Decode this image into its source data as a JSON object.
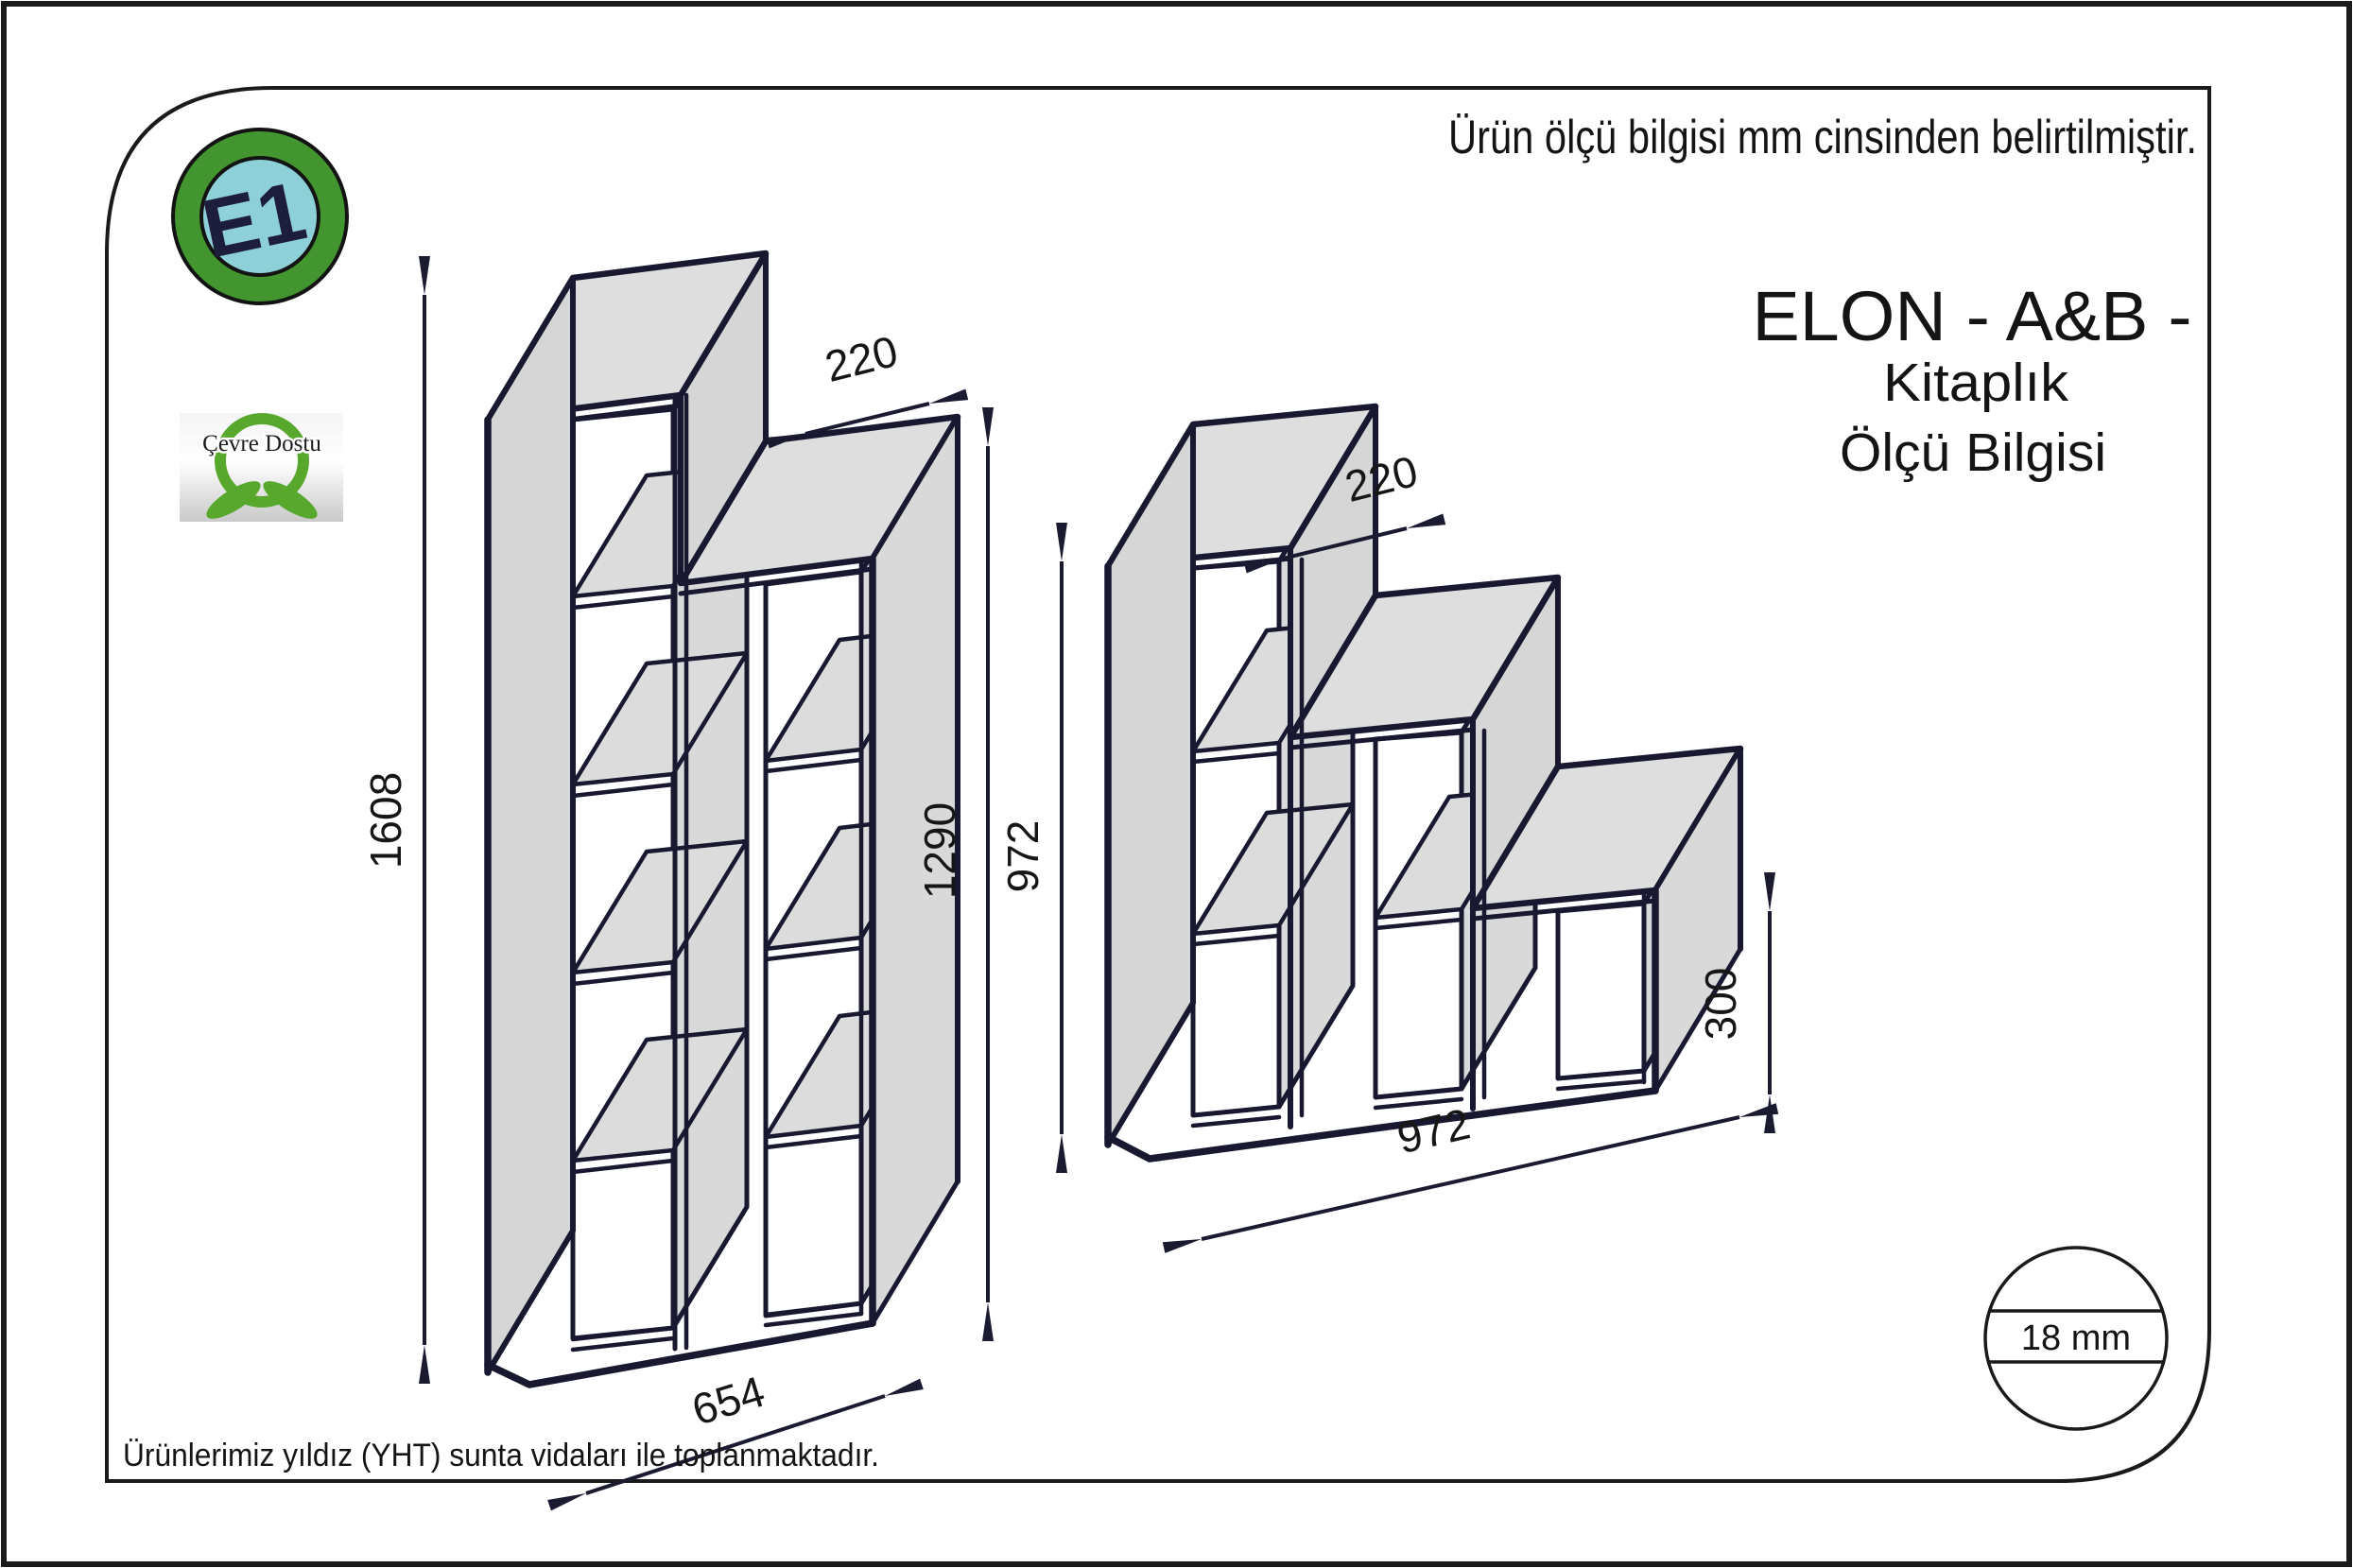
{
  "page": {
    "unit_note": "Ürün ölçü bilgisi mm cinsinden belirtilmiştir.",
    "assembly_note": "Ürünlerimiz yıldız (YHT) sunta vidaları ile toplanmaktadır.",
    "title": "ELON - A&B -",
    "subtitle1": "Kitaplık",
    "subtitle2": "Ölçü Bilgisi"
  },
  "badges": {
    "e1": "E1",
    "eco": "Çevre Dostu"
  },
  "material": {
    "thickness_label": "18 mm"
  },
  "shelf_a": {
    "height_left_mm": "1608",
    "height_right_mm": "1290",
    "depth_mm": "220",
    "width_mm": "654"
  },
  "shelf_b": {
    "height_mm": "972",
    "depth_mm": "220",
    "step_height_mm": "300",
    "width_mm": "972"
  },
  "colors": {
    "line": "#181830",
    "panel_gray": "#d6d6d6",
    "top_gray": "#dedede",
    "e1_ring_green": "#43962f",
    "e1_center_teal": "#8ed0d8",
    "eco_green": "#58a82e"
  }
}
